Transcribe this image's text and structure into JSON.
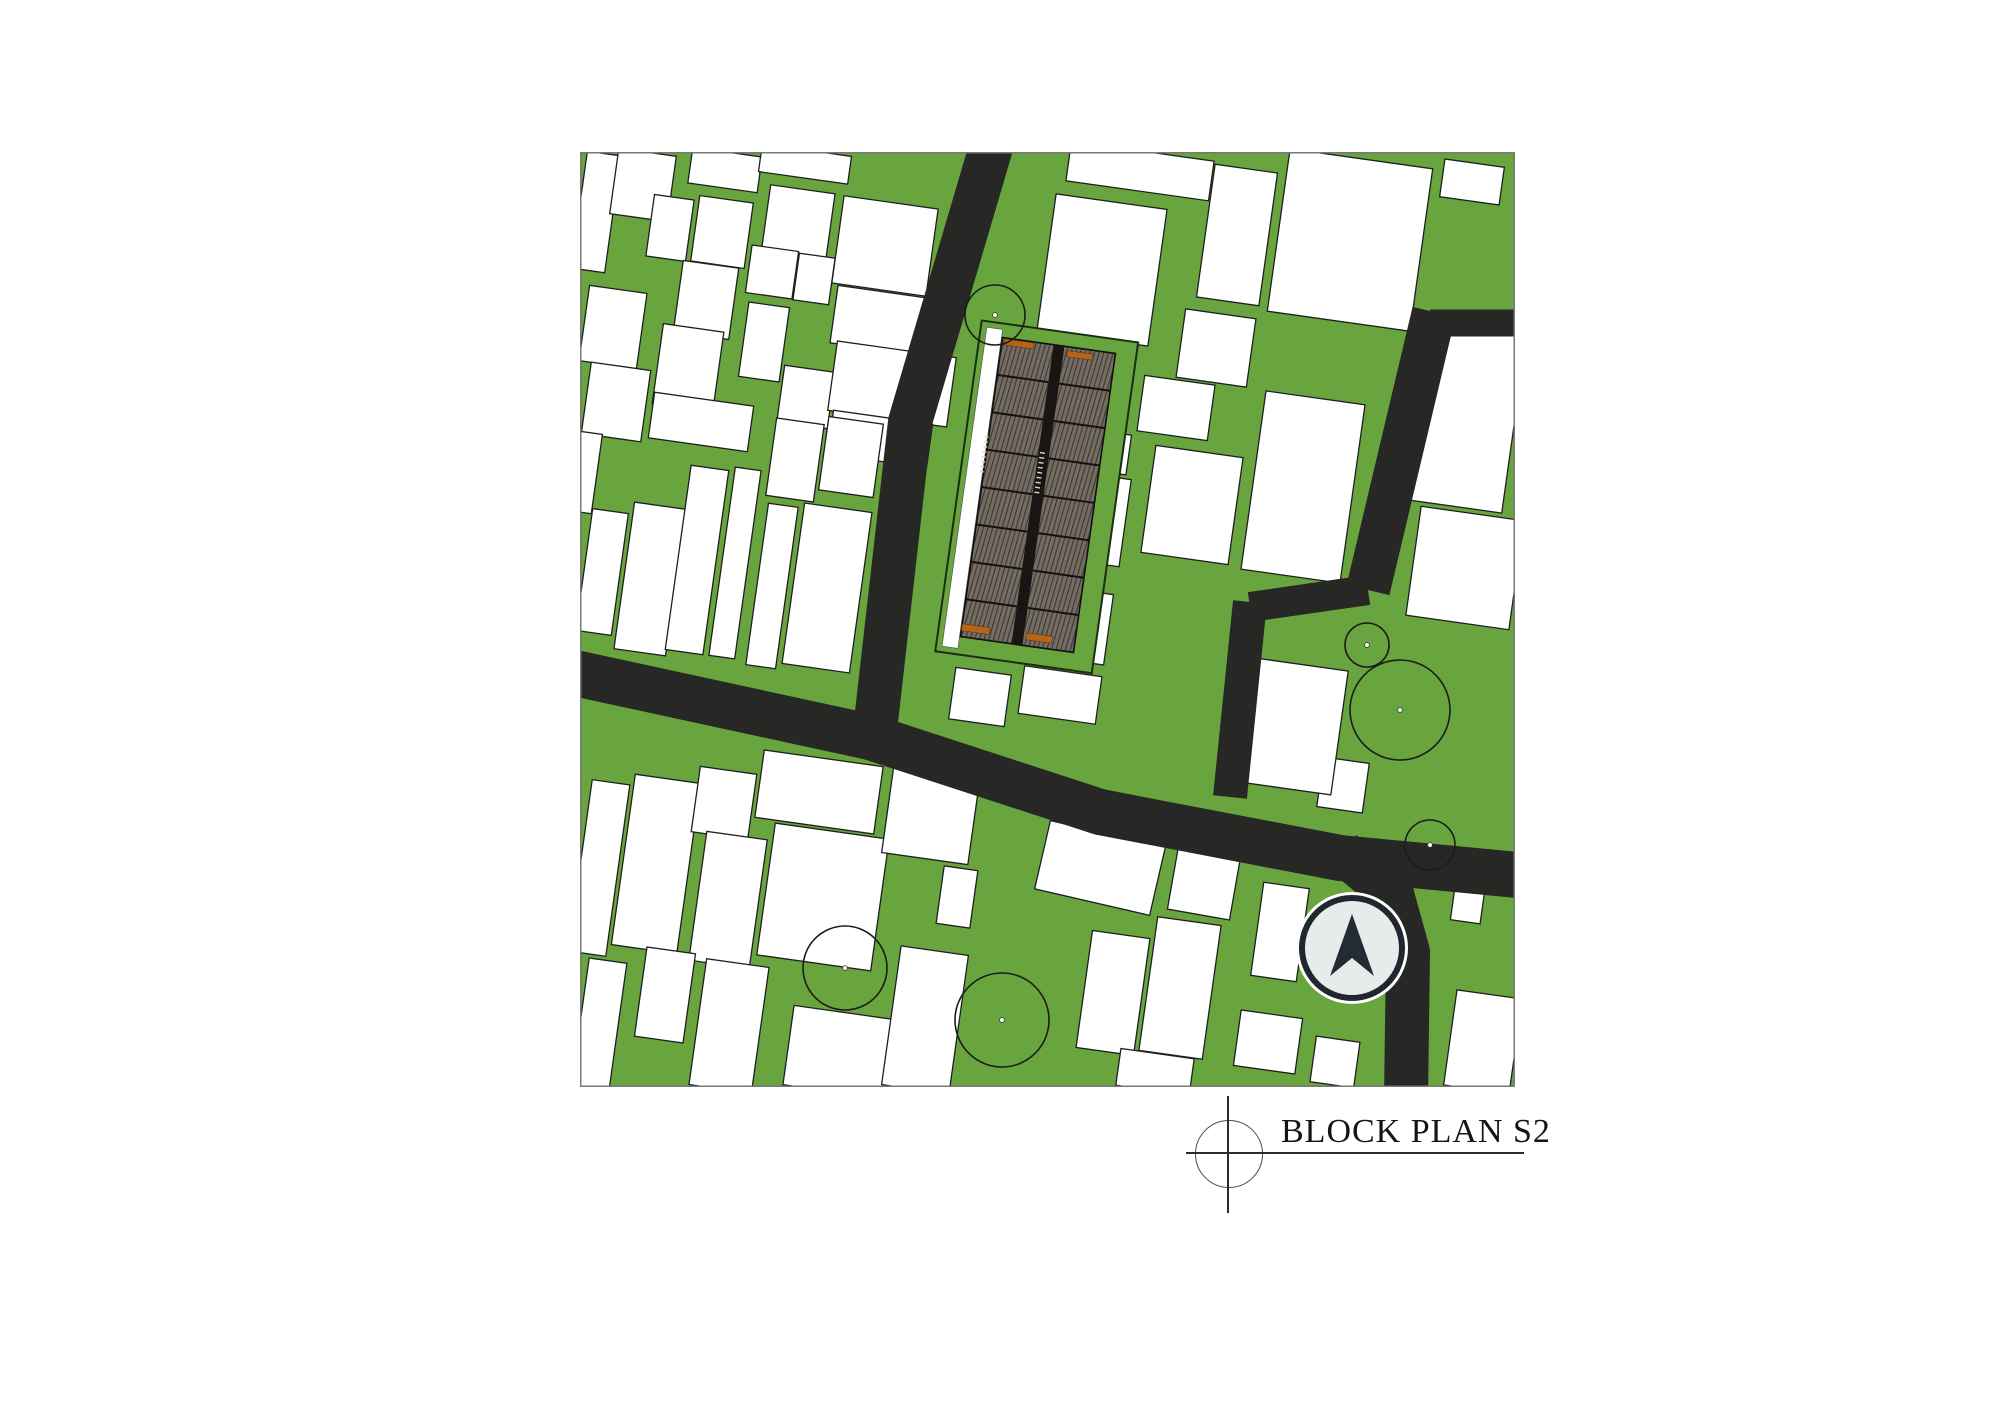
{
  "title_block": {
    "label": "BLOCK PLAN S2",
    "text_x": 1281,
    "text_y": 1113,
    "font_size": 34,
    "crosshair": {
      "cx": 1228,
      "cy": 1153,
      "r": 33
    },
    "vline": {
      "x": 1227,
      "y1": 1096,
      "y2": 1213,
      "w": 2
    },
    "hline": {
      "x1": 1186,
      "x2": 1524,
      "y": 1152,
      "h": 2
    }
  },
  "palette": {
    "page_bg": "#ffffff",
    "grass_green": "#69a53e",
    "road_dark": "#272725",
    "block_fill": "#ffffff",
    "block_stroke": "#1f1f1f",
    "map_border": "#787878",
    "panel_fill": "#756c63",
    "panel_line": "#24201c",
    "spine_dark": "#181512",
    "site_outline": "#1b2e12",
    "orange_accent": "#b5641c",
    "tree_stroke": "#1c1c1c",
    "arrow_ring": "#20272e",
    "arrow_bg": "#e7eceb",
    "arrow_fill": "#232b35",
    "tick_white": "#d8d8d4"
  },
  "map": {
    "x": 580,
    "y": 152,
    "size": 935,
    "default_block_rotation": 8,
    "blocks": [
      [
        16,
        60,
        34,
        118,
        8
      ],
      [
        33,
        175,
        58,
        76,
        8
      ],
      [
        36,
        250,
        60,
        72,
        8
      ],
      [
        63,
        33,
        58,
        66,
        8
      ],
      [
        90,
        76,
        40,
        62,
        8
      ],
      [
        142,
        80,
        54,
        66,
        8
      ],
      [
        126,
        148,
        56,
        72,
        8
      ],
      [
        108,
        216,
        61,
        81,
        8
      ],
      [
        121,
        270,
        100,
        46,
        8
      ],
      [
        218,
        72,
        65,
        70,
        8
      ],
      [
        192,
        120,
        47,
        48,
        8
      ],
      [
        234,
        127,
        36,
        47,
        8
      ],
      [
        184,
        190,
        41,
        75,
        8
      ],
      [
        226,
        245,
        51,
        57,
        8
      ],
      [
        305,
        94,
        95,
        88,
        8
      ],
      [
        310,
        170,
        113,
        58,
        8
      ],
      [
        312,
        232,
        120,
        70,
        8
      ],
      [
        300,
        287,
        100,
        44,
        8
      ],
      [
        145,
        18,
        70,
        36,
        8
      ],
      [
        225,
        12,
        90,
        28,
        8
      ],
      [
        22,
        420,
        36,
        123,
        8
      ],
      [
        70,
        427,
        52,
        148,
        8
      ],
      [
        117,
        408,
        38,
        186,
        8
      ],
      [
        155,
        411,
        26,
        190,
        8
      ],
      [
        192,
        434,
        30,
        163,
        8
      ],
      [
        215,
        308,
        48,
        78,
        8
      ],
      [
        247,
        436,
        68,
        162,
        8
      ],
      [
        271,
        305,
        55,
        74,
        8
      ],
      [
        2,
        320,
        30,
        80,
        8
      ],
      [
        19,
        716,
        38,
        173,
        8
      ],
      [
        76,
        712,
        66,
        172,
        8
      ],
      [
        144,
        651,
        57,
        66,
        8
      ],
      [
        148,
        748,
        61,
        130,
        8
      ],
      [
        239,
        640,
        120,
        68,
        8
      ],
      [
        243,
        745,
        115,
        133,
        8
      ],
      [
        351,
        662,
        87,
        90,
        8
      ],
      [
        377,
        745,
        34,
        58,
        8
      ],
      [
        85,
        843,
        49,
        90,
        8
      ],
      [
        149,
        874,
        63,
        127,
        8
      ],
      [
        258,
        900,
        100,
        80,
        8
      ],
      [
        345,
        868,
        68,
        140,
        8
      ],
      [
        19,
        873,
        38,
        130,
        8
      ],
      [
        520,
        716,
        118,
        70,
        13
      ],
      [
        624,
        731,
        63,
        64,
        10
      ],
      [
        700,
        780,
        46,
        94,
        8
      ],
      [
        533,
        841,
        58,
        118,
        8
      ],
      [
        600,
        836,
        64,
        135,
        8
      ],
      [
        575,
        920,
        74,
        37,
        8
      ],
      [
        688,
        890,
        62,
        56,
        8
      ],
      [
        755,
        910,
        44,
        46,
        8
      ],
      [
        763,
        633,
        46,
        50,
        8
      ],
      [
        888,
        750,
        30,
        40,
        8
      ],
      [
        903,
        890,
        66,
        96,
        8
      ],
      [
        480,
        471,
        98,
        71,
        8
      ],
      [
        480,
        543,
        78,
        48,
        8
      ],
      [
        400,
        545,
        56,
        52,
        8
      ],
      [
        710,
        574,
        100,
        125,
        8
      ],
      [
        723,
        335,
        100,
        180,
        8
      ],
      [
        596,
        256,
        71,
        56,
        8
      ],
      [
        612,
        353,
        88,
        108,
        8
      ],
      [
        508,
        366,
        75,
        88,
        8
      ],
      [
        520,
        299,
        58,
        40,
        8
      ],
      [
        636,
        196,
        71,
        69,
        8
      ],
      [
        770,
        88,
        144,
        164,
        8
      ],
      [
        657,
        83,
        63,
        134,
        8
      ],
      [
        892,
        30,
        60,
        38,
        8
      ],
      [
        560,
        19,
        144,
        40,
        8
      ],
      [
        522,
        118,
        112,
        138,
        8
      ],
      [
        885,
        263,
        100,
        184,
        8
      ],
      [
        885,
        416,
        104,
        110,
        8
      ]
    ],
    "roads": [
      {
        "name": "road-north-vertical",
        "points": [
          [
            412,
            -8
          ],
          [
            330,
            270
          ],
          [
            295,
            578
          ]
        ],
        "width": 44
      },
      {
        "name": "road-main-diagonal",
        "points": [
          [
            -10,
            520
          ],
          [
            290,
            585
          ],
          [
            520,
            660
          ],
          [
            760,
            706
          ],
          [
            948,
            724
          ]
        ],
        "width": 46
      },
      {
        "name": "road-south-branch",
        "points": [
          [
            762,
            700
          ],
          [
            812,
            742
          ],
          [
            828,
            800
          ],
          [
            826,
            948
          ]
        ],
        "width": 44
      },
      {
        "name": "road-east-stub",
        "points": [
          [
            850,
            171
          ],
          [
            948,
            171
          ]
        ],
        "width": 27
      },
      {
        "name": "road-east-vertical-upper",
        "points": [
          [
            854,
            160
          ],
          [
            788,
            438
          ]
        ],
        "width": 44
      },
      {
        "name": "road-east-jog",
        "points": [
          [
            788,
            438
          ],
          [
            670,
            455
          ]
        ],
        "width": 30
      },
      {
        "name": "road-east-vertical-lower",
        "points": [
          [
            670,
            450
          ],
          [
            650,
            645
          ]
        ],
        "width": 34
      }
    ],
    "trees": [
      [
        415,
        163,
        30
      ],
      [
        787,
        493,
        22
      ],
      [
        820,
        558,
        50
      ],
      [
        850,
        693,
        25
      ],
      [
        265,
        816,
        42
      ],
      [
        422,
        868,
        47
      ]
    ],
    "site": {
      "rotation": 8,
      "pivot": [
        458,
        343
      ],
      "plot": {
        "x": 378,
        "y": 178,
        "w": 158,
        "h": 334
      },
      "sidewalk": {
        "x": 384,
        "y": 184,
        "w": 16,
        "h": 322
      },
      "building": {
        "x": 401,
        "y": 192,
        "w": 114,
        "h": 302
      },
      "spine": {
        "x": 452.5,
        "y": 192,
        "w": 11,
        "h": 302
      },
      "columns": [
        {
          "x": 401,
          "w": 51.5
        },
        {
          "x": 463.5,
          "w": 51.5
        }
      ],
      "rows": 8,
      "orange_units": [
        [
          403,
          193,
          30,
          6
        ],
        [
          467,
          196,
          26,
          6
        ],
        [
          401,
          481,
          28,
          7
        ],
        [
          466,
          481,
          26,
          7
        ]
      ],
      "tick_groups": [
        {
          "x": 397,
          "y0": 292,
          "n": 8,
          "step": 5,
          "w": 4,
          "h": 1.4
        },
        {
          "x": 454,
          "y0": 300,
          "n": 9,
          "step": 5,
          "w": 5,
          "h": 1.4
        }
      ]
    },
    "north_arrow": {
      "cx": 772,
      "cy": 796,
      "r_halo": 56,
      "r_ring": 50,
      "ring_w": 6,
      "needle": [
        [
          772,
          762
        ],
        [
          794,
          824
        ],
        [
          772,
          806
        ],
        [
          750,
          824
        ]
      ]
    }
  }
}
